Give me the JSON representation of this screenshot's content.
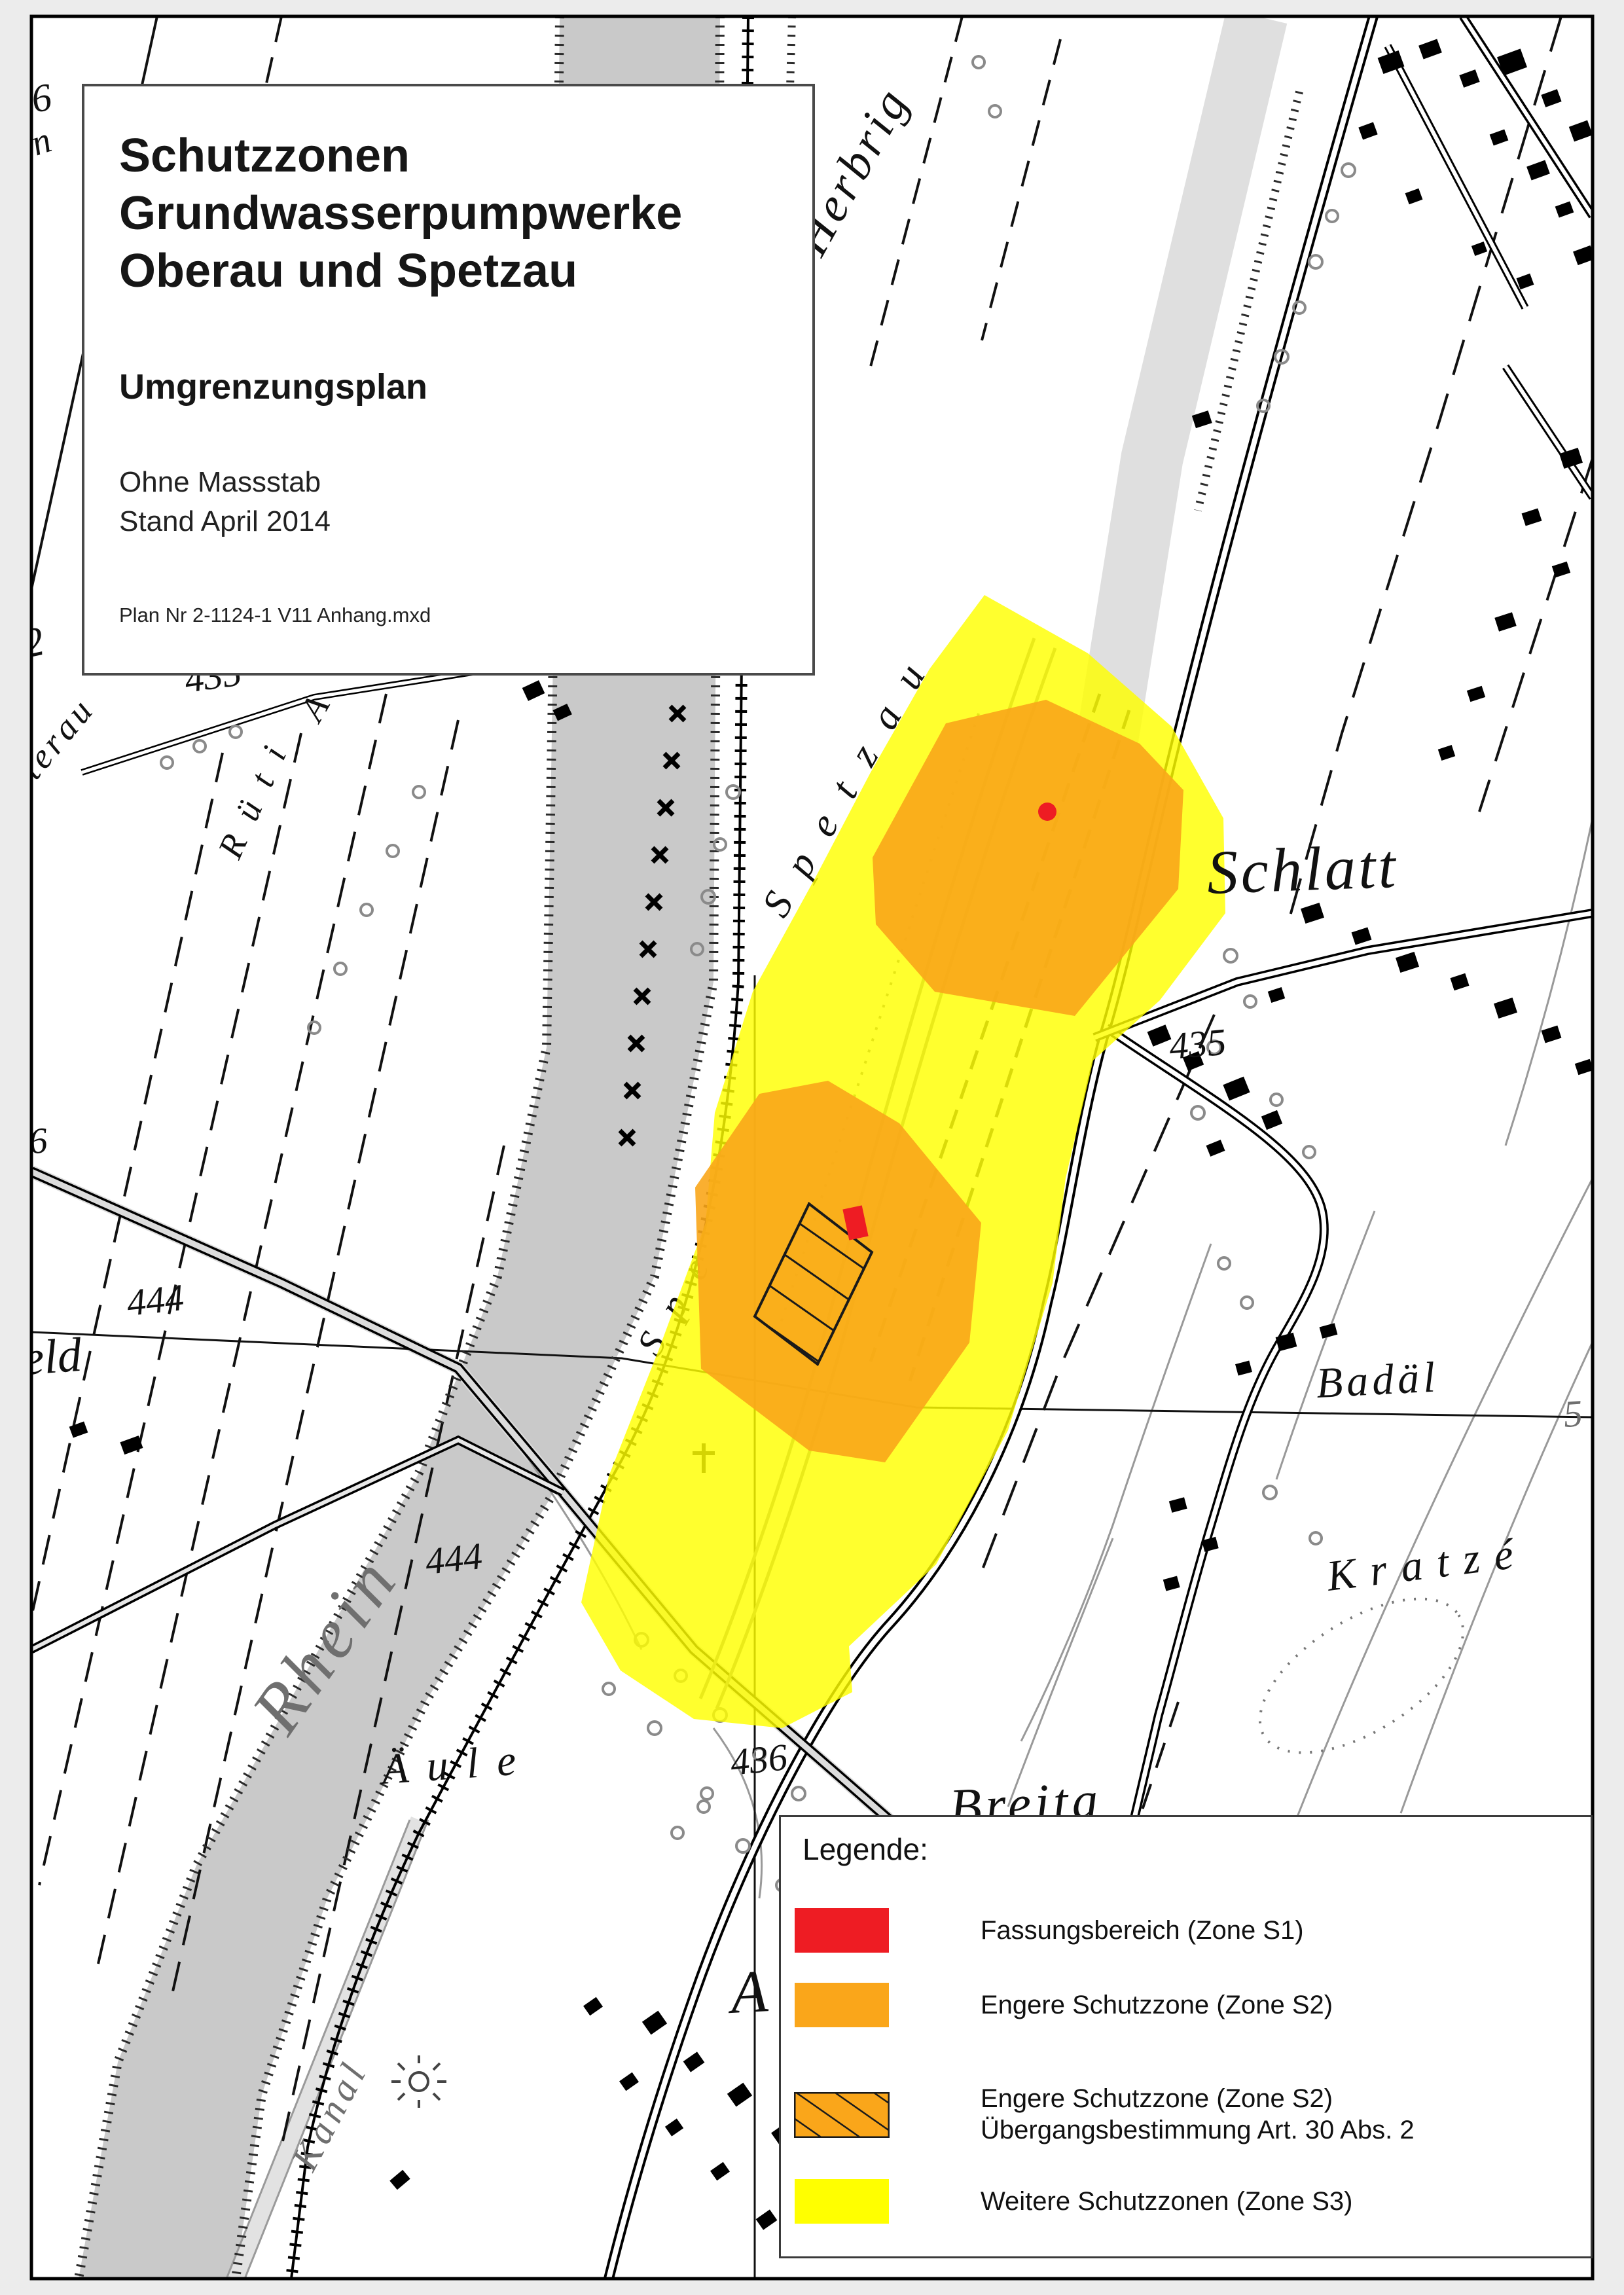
{
  "page": {
    "background": "#ececec",
    "map_border_color": "#000000"
  },
  "title_box": {
    "line1": "Schutzzonen",
    "line2": "Grundwasserpumpwerke",
    "line3": "Oberau und Spetzau",
    "subtitle": "Umgrenzungsplan",
    "note1": "Ohne Massstab",
    "note2": "Stand April 2014",
    "plan_nr": "Plan Nr 2-1124-1 V11 Anhang.mxd"
  },
  "legend": {
    "heading": "Legende:",
    "items": [
      {
        "label": "Fassungsbereich (Zone S1)",
        "label2": "",
        "color": "#ee1c23",
        "hatched": false
      },
      {
        "label": "Engere Schutzzone (Zone S2)",
        "label2": "",
        "color": "#faa61a",
        "hatched": false
      },
      {
        "label": "Engere Schutzzone (Zone S2)",
        "label2": "Übergangsbestimmung Art. 30 Abs. 2",
        "color": "#faa61a",
        "hatched": true
      },
      {
        "label": "Weitere Schutzzonen (Zone S3)",
        "label2": "",
        "color": "#ffff00",
        "hatched": false
      }
    ]
  },
  "colors": {
    "zone_s1": "#ee1c23",
    "zone_s2": "#faa61a",
    "zone_s3": "#ffff00",
    "river": "#c9c9c9",
    "road_band": "#dedede",
    "gray_label": "#6f6f6f",
    "contour": "#999999"
  },
  "map_labels": {
    "herbrig": "Herbrig",
    "schlatt": "Schlatt",
    "spetzau": "Spetzau",
    "spetzau_fragment": "Spe",
    "rhein": "Rhein",
    "kanal": "Kanal",
    "aeule": "Äule",
    "badael": "Badäl",
    "kratze": "Kratzé",
    "breita": "Breita",
    "rueti": "Rüti",
    "rueti_a": "A",
    "interau": "interau",
    "eld": "eld",
    "a_fragment": "A",
    "elev_435_left": "435",
    "elev_435_right": "435",
    "elev_444_upper": "444",
    "elev_444_lower": "444",
    "elev_436": "436",
    "elev_26": "26",
    "elev_22": "22",
    "elev_6": "6",
    "elev_n": "n",
    "elev_5": "5"
  }
}
